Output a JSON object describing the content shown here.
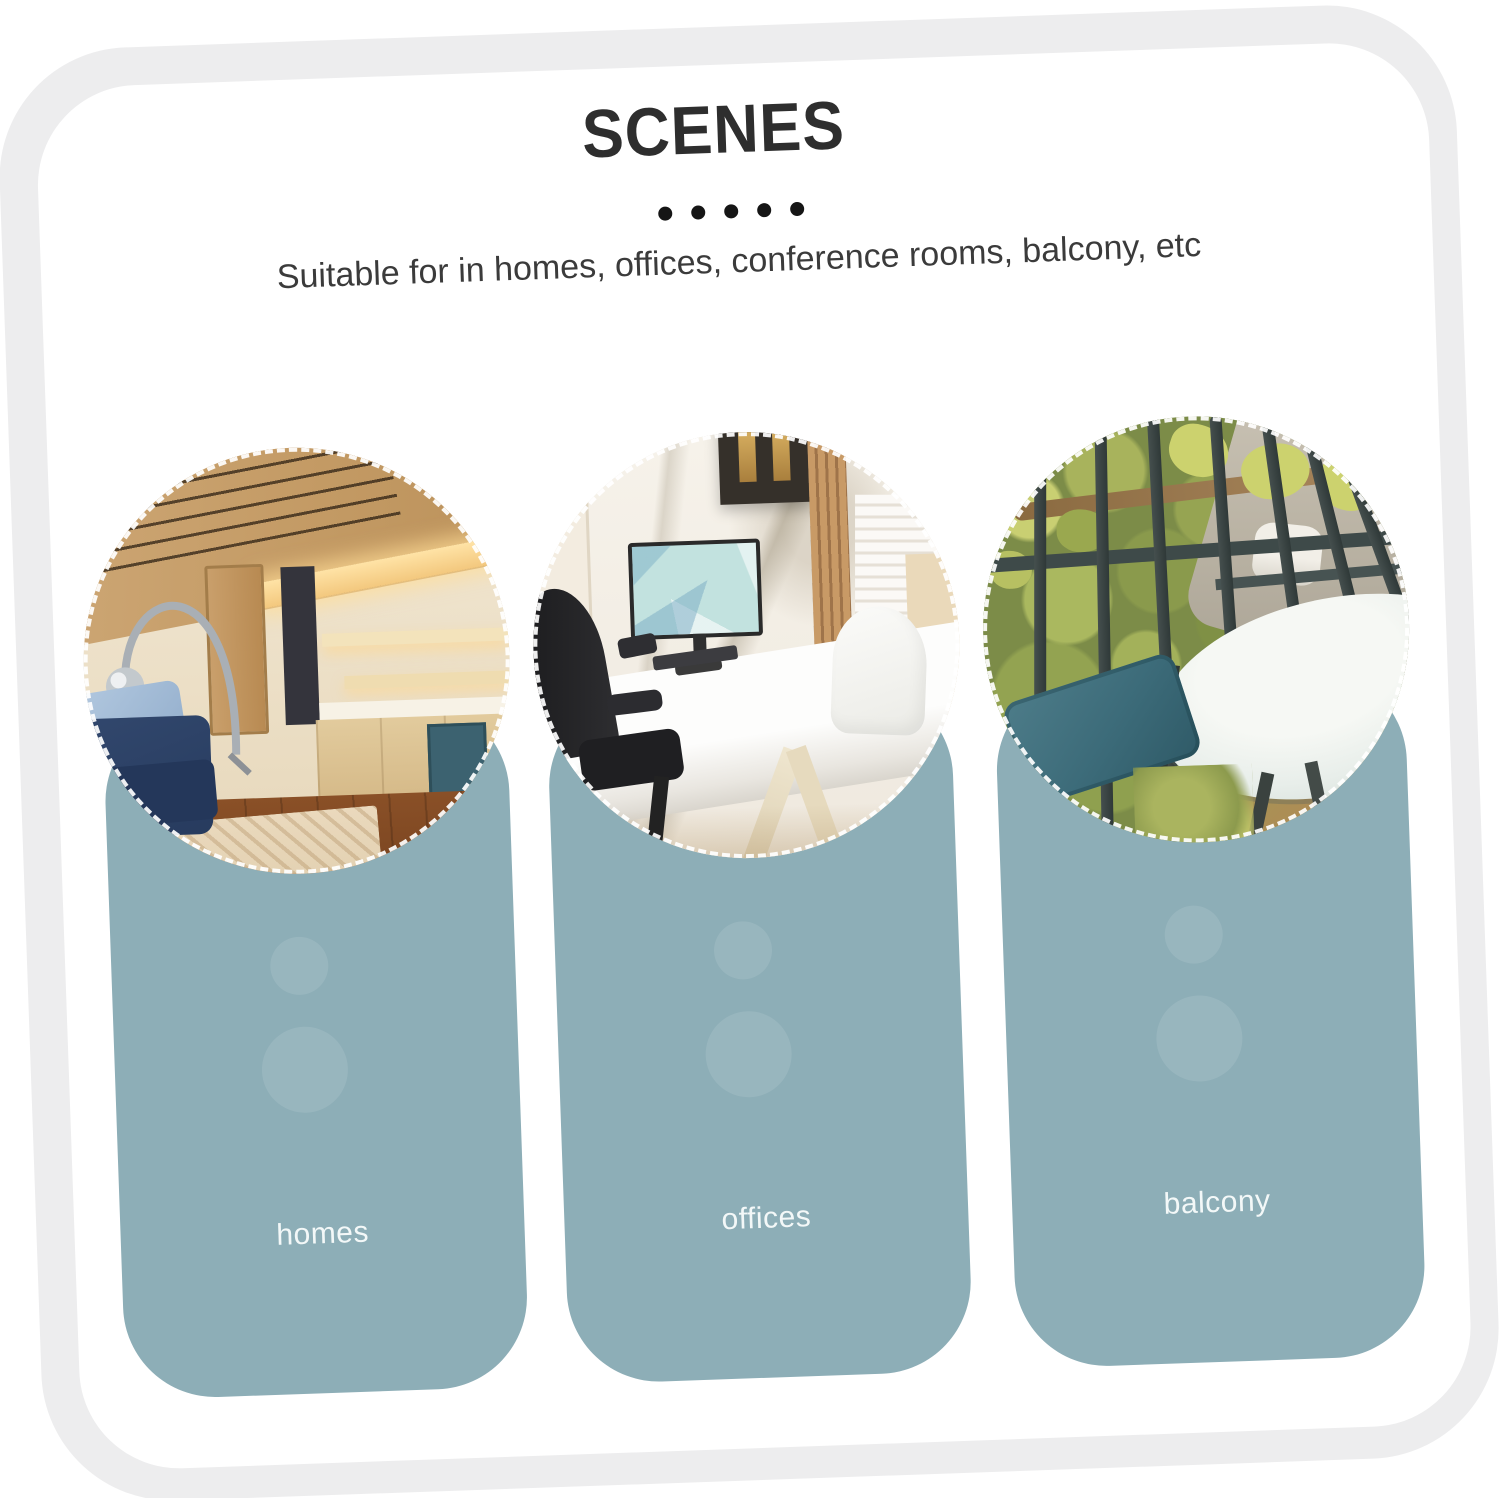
{
  "page": {
    "background": "#ffffff"
  },
  "colors": {
    "page-bg": "#ffffff",
    "frame": "#ededee",
    "frame-inner": "#ffffff",
    "title": "#2e2e2e",
    "subtitle": "#3b3b3b",
    "dot": "#151515",
    "card": "#8daeb7",
    "card-label": "#f3f8f8"
  },
  "header": {
    "title": "SCENES",
    "dots_count": 5,
    "subtitle": "Suitable for in homes, offices, conference rooms, balcony, etc"
  },
  "scenes": [
    {
      "label": "homes",
      "photo_alt": "living room and kitchen with wooden ceiling, arc floor lamp, navy sofa and wood floor"
    },
    {
      "label": "offices",
      "photo_alt": "office desk with monitor, black office chair, white chair and marble wall"
    },
    {
      "label": "balcony",
      "photo_alt": "balcony with wrought iron railing, greenery, round white table and blue chair cushion"
    }
  ]
}
